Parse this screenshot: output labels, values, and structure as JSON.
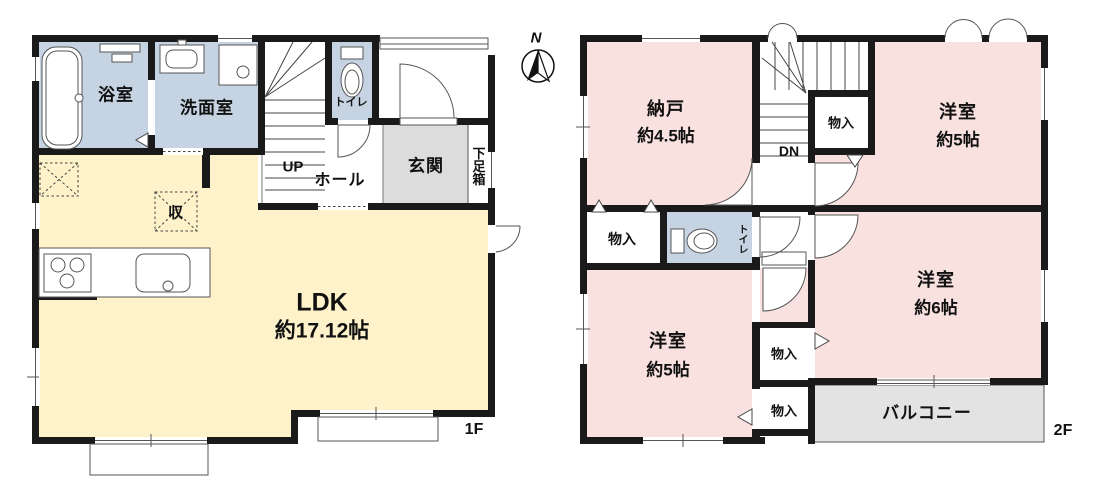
{
  "title": "住宅間取り図 1F・2F",
  "compass": {
    "north": "N"
  },
  "floor1": {
    "floor_label": "1F",
    "stairs_direction": "UP",
    "rooms": {
      "bathroom": "浴室",
      "washroom": "洗面室",
      "toilet": "トイレ",
      "hall": "ホール",
      "entrance": "玄関",
      "shoe_box": "下足箱",
      "storage": "収",
      "ldk": "LDK"
    },
    "areas": {
      "ldk": "約17.12帖"
    }
  },
  "floor2": {
    "floor_label": "2F",
    "stairs_direction": "DN",
    "rooms": {
      "storage_room": "納戸",
      "western_room_ne": "洋室",
      "western_room_se": "洋室",
      "western_room_sw": "洋室",
      "toilet": "トイレ",
      "closet_top": "物入",
      "closet_mid": "物入",
      "closet_bottom_upper": "物入",
      "closet_bottom_lower": "物入",
      "balcony": "バルコニー"
    },
    "areas": {
      "storage_room": "約4.5帖",
      "western_room_ne": "約5帖",
      "western_room_se": "約6帖",
      "western_room_sw": "約5帖"
    }
  },
  "colors": {
    "wall": "#1a1a1a",
    "wet": "#c5d3e2",
    "ldk": "#fdf2c9",
    "room": "#f8e1df",
    "entry": "#dcdcdc",
    "balcony": "#e3e3e3"
  }
}
